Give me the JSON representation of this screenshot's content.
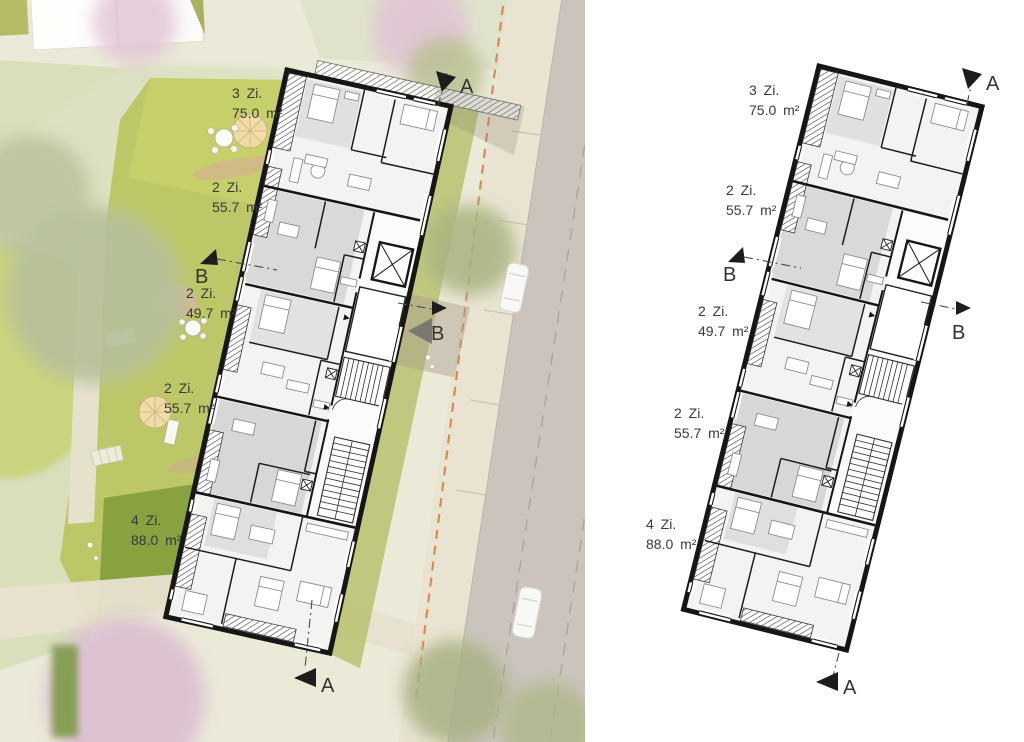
{
  "page": {
    "description": "Architectural ground-floor plan: site plan with landscape (left) and isolated floor plan (right)"
  },
  "apartments": [
    {
      "rooms": "3 Zi.",
      "area": "75.0 m²"
    },
    {
      "rooms": "2 Zi.",
      "area": "55.7 m²"
    },
    {
      "rooms": "2 Zi.",
      "area": "49.7 m²"
    },
    {
      "rooms": "2 Zi.",
      "area": "55.7 m²"
    },
    {
      "rooms": "4 Zi.",
      "area": "88.0 m²"
    }
  ],
  "section_markers": {
    "a": "A",
    "b": "B"
  },
  "colors": {
    "wall_black": "#161616",
    "garden_green": "#bdc768",
    "lawn_dark_green": "#87a23f",
    "park_sage": "#d8dfba",
    "path_beige": "#e5e0cb",
    "sidewalk_beige": "#e9e4d1",
    "road_gray": "#cbc4bd",
    "orange_dashed_line": "#dd8a50",
    "room_gray": "#d9d9d7",
    "blossom_pink": "#ddbfd2",
    "label_text": "#3a3a3a"
  }
}
